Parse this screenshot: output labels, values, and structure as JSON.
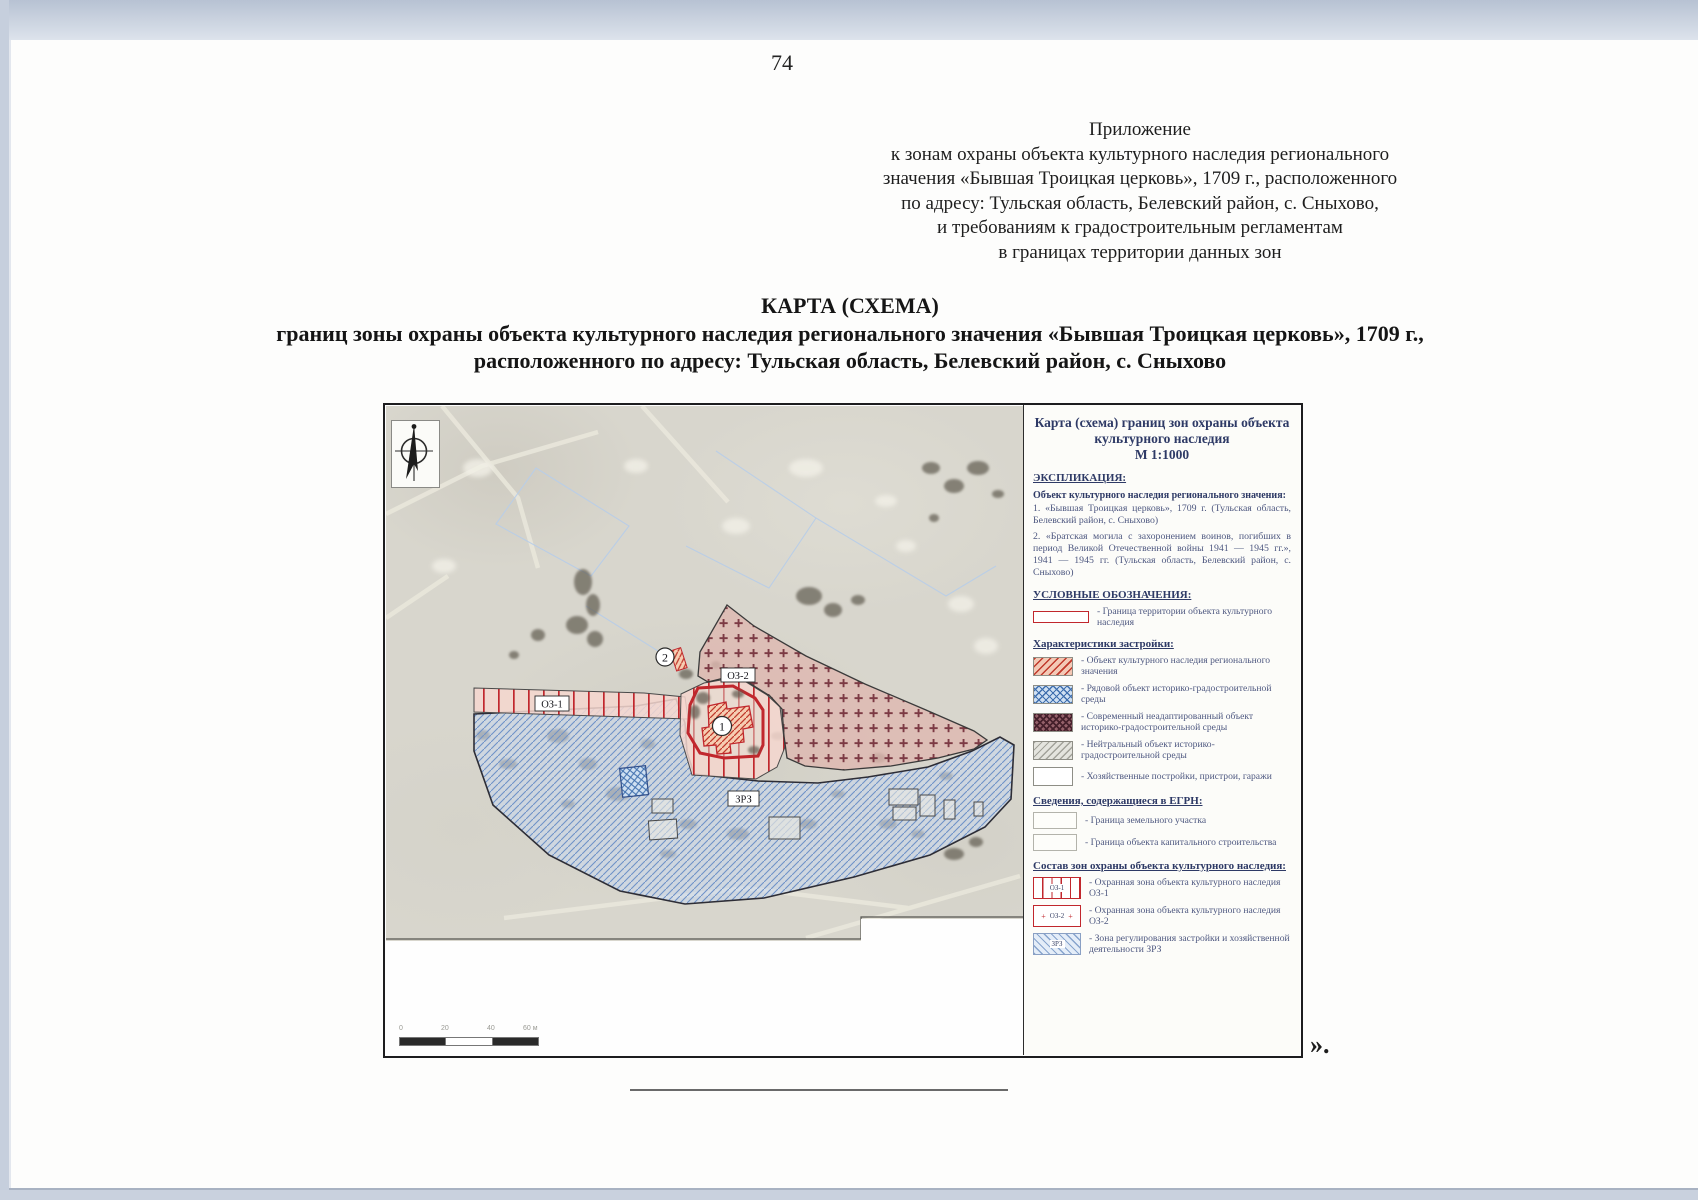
{
  "page": {
    "number": "74",
    "closing_mark": "»."
  },
  "annex": {
    "lines": [
      "Приложение",
      "к зонам охраны объекта культурного наследия регионального",
      "значения «Бывшая Троицкая церковь», 1709 г., расположенного",
      "по адресу: Тульская область, Белевский район, с. Сныхово,",
      "и требованиям к градостроительным регламентам",
      "в границах территории данных зон"
    ]
  },
  "title": {
    "lines": [
      "КАРТА (СХЕМА)",
      "границ зоны охраны объекта культурного наследия регионального значения «Бывшая Троицкая церковь», 1709 г.,",
      "расположенного по адресу: Тульская область, Белевский район, с. Сныхово"
    ]
  },
  "map": {
    "legend": {
      "title_lines": [
        "Карта (схема) границ зон охраны объекта",
        "культурного наследия",
        "М 1:1000"
      ],
      "explication_header": "ЭКСПЛИКАЦИЯ:",
      "object_header": "Объект культурного наследия регионального значения:",
      "object_items": [
        "1. «Бывшая Троицкая церковь», 1709 г. (Тульская область, Белевский район, с. Сныхово)",
        "2. «Братская могила с захоронением воинов, погибших в период Великой Отечественной войны 1941 — 1945 гг.», 1941 — 1945 гг. (Тульская область, Белевский район, с. Сныхово)"
      ],
      "symbols_header": "УСЛОВНЫЕ ОБОЗНАЧЕНИЯ:",
      "boundary_item": "- Граница территории объекта культурного наследия",
      "buildings_header": "Характеристики застройки:",
      "buildings": [
        {
          "swatch": "red-diagonal-hatch",
          "label": "- Объект культурного наследия регионального значения"
        },
        {
          "swatch": "blue-crosshatch",
          "label": "- Рядовой объект историко-градостроительной среды"
        },
        {
          "swatch": "dark-crosshatch",
          "label": "- Современный неадаптированный объект историко-градостроительной среды"
        },
        {
          "swatch": "gray-diagonal-hatch",
          "label": "- Нейтральный объект историко-градостроительной среды"
        },
        {
          "swatch": "empty",
          "label": "- Хозяйственные постройки, пристрои, гаражи"
        }
      ],
      "egrn_header": "Сведения, содержащиеся в ЕГРН:",
      "egrn_items": [
        {
          "swatch": "parcel-boundary",
          "label": "- Граница земельного участка"
        },
        {
          "swatch": "capital-object-boundary",
          "label": "- Граница объекта капитального строительства"
        }
      ],
      "zones_header": "Состав зон охраны объекта культурного наследия:",
      "zones": [
        {
          "code": "ОЗ-1",
          "label": "- Охранная зона объекта культурного наследия ОЗ-1"
        },
        {
          "code": "ОЗ-2",
          "label": "- Охранная зона объекта культурного наследия ОЗ-2"
        },
        {
          "code": "ЗРЗ",
          "label": "- Зона регулирования застройки и хозяйственной деятельности ЗРЗ"
        }
      ]
    },
    "labels": {
      "oz1": "ОЗ-1",
      "oz2": "ОЗ-2",
      "zrz": "ЗРЗ",
      "point1": "1",
      "point2": "2"
    },
    "scale": {
      "ticks": [
        "0",
        "20",
        "40",
        "60 м"
      ]
    },
    "colors": {
      "heritage_boundary_red": "#c1272d",
      "zrz_blue": "#6f92c8",
      "oz2_plus": "#7c3a44",
      "legend_navy": "#2e3a66"
    }
  }
}
